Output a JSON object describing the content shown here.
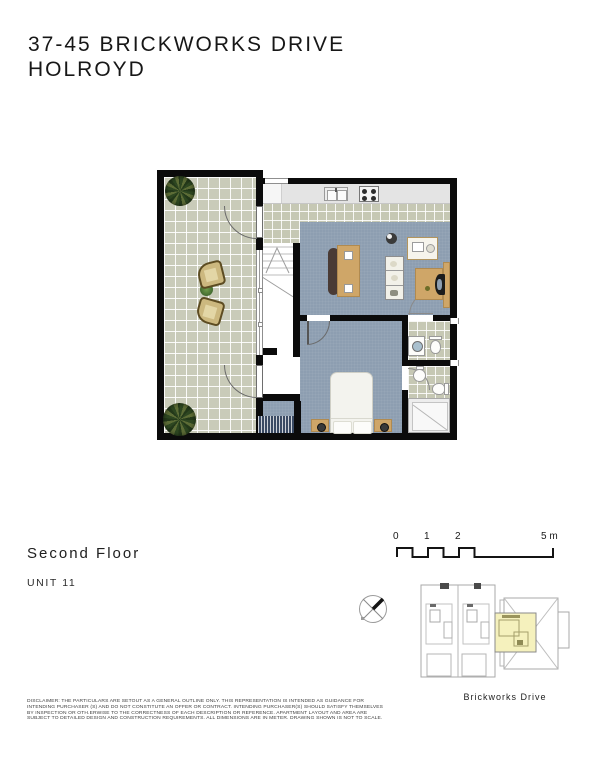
{
  "page": {
    "title_line1": "37-45 BRICKWORKS DRIVE",
    "title_line2": "HOLROYD"
  },
  "plan_info": {
    "floor_label": "Second Floor",
    "unit_label": "UNIT 11"
  },
  "scale_bar": {
    "labels": [
      "0",
      "1",
      "2",
      "5 m"
    ]
  },
  "key_plan": {
    "street_label": "Brickworks Drive",
    "highlight_color": "#f5f1bd"
  },
  "compass": {
    "icon": "compass-cross-north-east"
  },
  "floor_plan": {
    "rooms": [
      "terrace",
      "kitchen",
      "living-dining",
      "stairs",
      "bedroom",
      "laundry",
      "bathroom"
    ],
    "furniture_icons": [
      "potted-plant-icon",
      "outdoor-chair-icon",
      "kitchen-sink-icon",
      "cooktop-icon",
      "dining-table-icon",
      "dining-chairs-icon",
      "round-side-table-icon",
      "media-unit-icon",
      "shelf-unit-icon",
      "desk-icon",
      "office-chair-icon",
      "bed-icon",
      "nightstand-icon",
      "wardrobe-icon",
      "washing-machine-icon",
      "toilet-icon",
      "basin-icon",
      "shower-icon"
    ],
    "colors": {
      "wall": "#0b0b0b",
      "terrace_tile": "#c9cbb9",
      "interior_tile": "#c6c8b4",
      "carpet": "#8d9eb1",
      "counter": "#e4e4e4",
      "wood": "#cfa668"
    }
  },
  "disclaimer": {
    "lines": [
      "DISCLAIMER: THE PARTICULARS ARE SETOUT AS A GENERAL OUTLINE ONLY. THIS REPRESENTATION IS INTENDED AS GUIDANCE FOR",
      "INTENDING PURCHASER (S) AND DO NOT CONSTITUTE AN OFFER OR CONTRACT. INTENDING PURCHASER(S) SHOULD SATISFY THEMSELVES",
      "BY INSPECTION OR OTH.ERWISE TO THE CORRECTNESS OF EACH DESCRIPTION OR REFERENCE. APARTMENT LAYOUT AND AREA ARE",
      "SUBJECT TO DETAILED DESIGN AND CONSTRUCTION REQUIREMENTS. ALL DIMENSIONS ARE IN METER. DRAWING SHOWN IS NOT TO SCALE."
    ]
  }
}
